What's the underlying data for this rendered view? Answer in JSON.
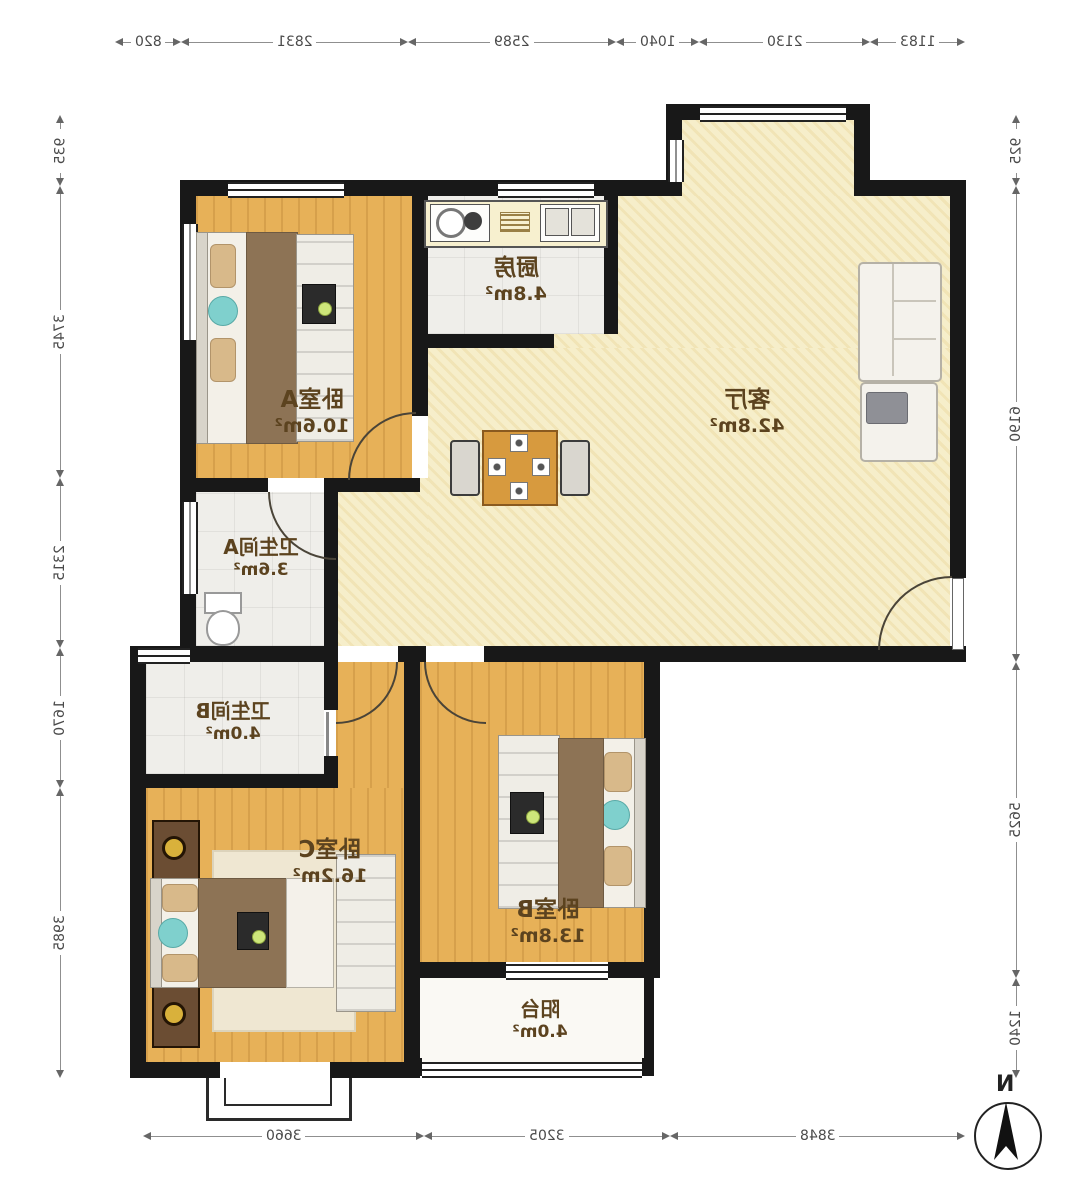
{
  "meta": {
    "type": "mirrored-floor-plan"
  },
  "rooms": {
    "bedroom_a": {
      "name": "卧室A",
      "area": "10.6m²"
    },
    "kitchen": {
      "name": "厨房",
      "area": "4.8m²"
    },
    "living": {
      "name": "客厅",
      "area": "42.8m²"
    },
    "bath_a": {
      "name": "卫生间A",
      "area": "3.6m²"
    },
    "bath_b": {
      "name": "卫生间B",
      "area": "4.0m²"
    },
    "bedroom_c": {
      "name": "卧室C",
      "area": "16.2m²"
    },
    "bedroom_b": {
      "name": "卧室B",
      "area": "13.8m²"
    },
    "balcony": {
      "name": "阳台",
      "area": "4.0m²"
    }
  },
  "dims": {
    "top": [
      "820",
      "2831",
      "2589",
      "1040",
      "2130",
      "1183"
    ],
    "bottom": [
      "3660",
      "3205",
      "3848"
    ],
    "left": [
      "935",
      "3745",
      "2315",
      "1670",
      "3985"
    ],
    "right": [
      "925",
      "6190",
      "5625",
      "1240"
    ]
  },
  "compass": {
    "label": "N"
  },
  "colors": {
    "wall": "#181818",
    "wood": "#e7b158",
    "living_floor": "#f6eeca",
    "tile": "#efeeea",
    "balcony_floor": "#faf9f4",
    "accent_teal": "#7fd0cd",
    "blanket": "#8d7355",
    "table_wood": "#d79a3e",
    "label": "#5c431f",
    "dim": "#4a4a4a"
  }
}
